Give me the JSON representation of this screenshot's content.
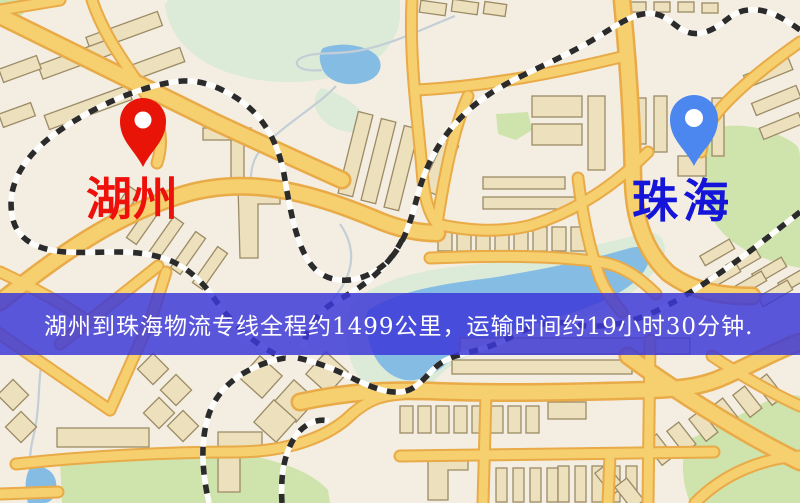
{
  "origin_marker": {
    "label": "湖州"
  },
  "destination_marker": {
    "label": "珠海"
  },
  "banner": {
    "text": "湖州到珠海物流专线全程约1499公里，运输时间约19小时30分钟."
  },
  "route": {
    "origin": "湖州",
    "destination": "珠海",
    "distance_km": "1499",
    "duration": "19小时30分钟"
  },
  "colors": {
    "bg": "#f4eee2",
    "road_core": "#f6cf6e",
    "road_casing": "#e9aa48",
    "railway": "#2b2b2b",
    "park": "#cfe3ac",
    "park_soft": "#dcead8",
    "water": "#85bce4",
    "stream": "#c3ced6",
    "building": "#ede0bd",
    "building_stroke": "#9b8b66",
    "origin_pin": "#e81408",
    "origin_label": "#ee100a",
    "dest_pin": "#4c86ef",
    "dest_label": "#1415d8",
    "banner_bg": "#3b38d8",
    "banner_text": "#ffffff"
  }
}
